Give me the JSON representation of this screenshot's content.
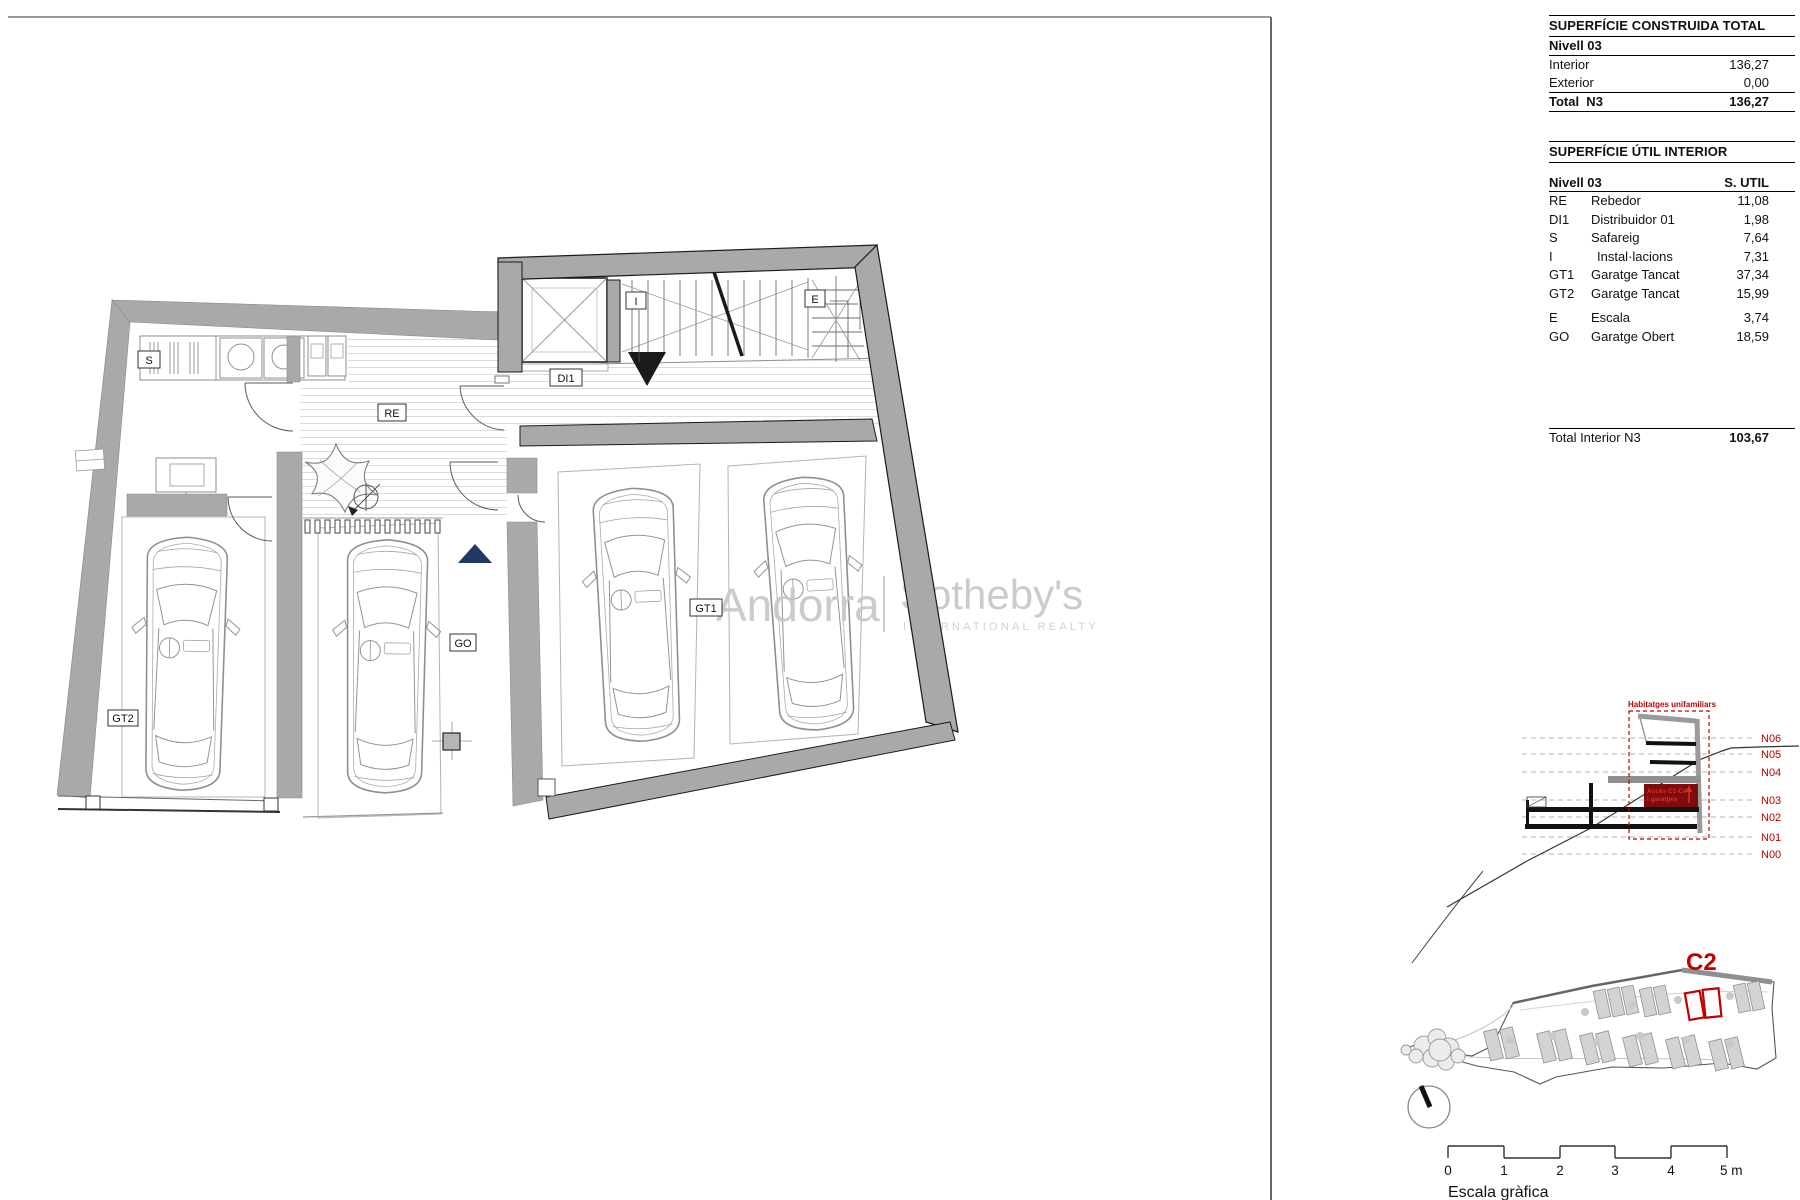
{
  "tables": {
    "construida": {
      "title": "SUPERFÍCIE CONSTRUIDA TOTAL",
      "subtitle": "Nivell 03",
      "rows": [
        {
          "label": "Interior",
          "value": "136,27"
        },
        {
          "label": "Exterior",
          "value": "0,00"
        }
      ],
      "total_label": "Total  N3",
      "total_value": "136,27"
    },
    "util": {
      "title": "SUPERFÍCIE ÚTIL INTERIOR",
      "header_left": "Nivell 03",
      "header_right": "S. UTIL",
      "rows": [
        {
          "code": "RE",
          "name": "Rebedor",
          "value": "11,08"
        },
        {
          "code": "DI1",
          "name": "Distribuidor 01",
          "value": "1,98"
        },
        {
          "code": "S",
          "name": "Safareig",
          "value": "7,64"
        },
        {
          "code": "I",
          "name": "Instal·lacions",
          "value": "7,31"
        },
        {
          "code": "GT1",
          "name": "Garatge Tancat",
          "value": "37,34"
        },
        {
          "code": "GT2",
          "name": "Garatge Tancat",
          "value": "15,99"
        },
        {
          "code": "E",
          "name": "Escala",
          "value": "3,74"
        },
        {
          "code": "GO",
          "name": "Garatge Obert",
          "value": "18,59"
        }
      ],
      "total_label": "Total Interior N3",
      "total_value": "103,67"
    }
  },
  "plan": {
    "rooms": {
      "s": "S",
      "re": "RE",
      "di1": "DI1",
      "i": "I",
      "e": "E",
      "gt1": "GT1",
      "gt2": "GT2",
      "go": "GO"
    }
  },
  "watermark": {
    "brand_left": "Andorra",
    "brand_right": "Sotheby's",
    "brand_sub": "INTERNATIONAL REALTY"
  },
  "section": {
    "title": "Habitatges unifamiliars",
    "access_line1": "Accés C1-C4",
    "access_line2": "i garatges",
    "levels": [
      "N06",
      "N05",
      "N04",
      "N03",
      "N02",
      "N01",
      "N00"
    ]
  },
  "site": {
    "label": "C2"
  },
  "scalebar": {
    "ticks": [
      "0",
      "1",
      "2",
      "3",
      "4",
      "5 m"
    ],
    "caption": "Escala gràfica"
  },
  "colors": {
    "wall": "#a9a9a9",
    "accent_red": "#c00000",
    "bright_red": "#e8291c",
    "dark_red": "#7d0d0d",
    "navy": "#1f3864",
    "watermark_gray": "#c9c9c9"
  }
}
